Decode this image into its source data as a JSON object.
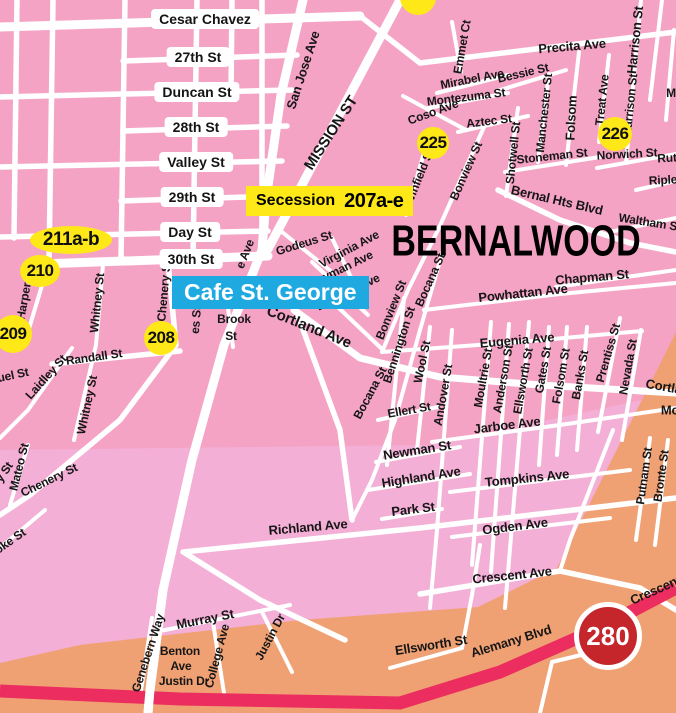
{
  "map": {
    "region_title": "BERNALWOOD",
    "colors": {
      "pink": "#F5A3C5",
      "light_pink": "#F3AFD6",
      "orange": "#F0A173",
      "road": "#FFFFFF",
      "freeway": "#EB2D5F",
      "yellow": "#FFE817",
      "blue": "#1EA9E1",
      "red": "#C4262B",
      "label_text": "#161616"
    },
    "banners": {
      "secession_name": "Secession",
      "secession_units": "207a-e",
      "cafe": "Cafe St. George"
    },
    "highway": {
      "shield": "280"
    },
    "pills": [
      {
        "t": "Cesar Chavez",
        "x": 205,
        "y": 19
      },
      {
        "t": "27th St",
        "x": 198,
        "y": 57
      },
      {
        "t": "Duncan St",
        "x": 197,
        "y": 92
      },
      {
        "t": "28th St",
        "x": 196,
        "y": 127
      },
      {
        "t": "Valley St",
        "x": 196,
        "y": 162
      },
      {
        "t": "29th St",
        "x": 192,
        "y": 197
      },
      {
        "t": "Day St",
        "x": 190,
        "y": 232
      },
      {
        "t": "30th St",
        "x": 191,
        "y": 259
      }
    ],
    "badges": [
      {
        "t": "225",
        "x": 433,
        "y": 143,
        "rx": 16,
        "ry": 16
      },
      {
        "t": "226",
        "x": 615,
        "y": 134,
        "rx": 17,
        "ry": 17
      },
      {
        "t": "208",
        "x": 161,
        "y": 338,
        "rx": 17,
        "ry": 17
      },
      {
        "t": "209",
        "x": 13,
        "y": 334,
        "rx": 19,
        "ry": 19
      },
      {
        "t": "210",
        "x": 40,
        "y": 271,
        "rx": 20,
        "ry": 16
      },
      {
        "t": "211a-b",
        "x": 71,
        "y": 240,
        "rx": 41,
        "ry": 14,
        "fs": 19
      },
      {
        "t": "",
        "x": 418,
        "y": -3,
        "rx": 18,
        "ry": 18
      }
    ],
    "labels": [
      {
        "t": "San Jose Ave",
        "x": 303,
        "y": 70,
        "r": -72
      },
      {
        "t": "MISSION ST",
        "x": 331,
        "y": 133,
        "r": -57,
        "fs": 15
      },
      {
        "t": "Emmet Ct",
        "x": 462,
        "y": 47,
        "r": -80,
        "fs": 12
      },
      {
        "t": "Precita Ave",
        "x": 572,
        "y": 46,
        "r": -5
      },
      {
        "t": "Harrison St",
        "x": 635,
        "y": 40,
        "r": -84
      },
      {
        "t": "Harrison St",
        "x": 630,
        "y": 105,
        "r": -84,
        "fs": 12
      },
      {
        "t": "Treat Ave",
        "x": 602,
        "y": 100,
        "r": -84,
        "fs": 12
      },
      {
        "t": "Folsom",
        "x": 571,
        "y": 118,
        "r": -87
      },
      {
        "t": "Manchester St",
        "x": 544,
        "y": 113,
        "r": -84,
        "fs": 12
      },
      {
        "t": "Mirabel Ave",
        "x": 472,
        "y": 79,
        "r": -11,
        "fs": 12
      },
      {
        "t": "Bessie St",
        "x": 523,
        "y": 73,
        "r": -13,
        "fs": 12
      },
      {
        "t": "Montezuma St",
        "x": 466,
        "y": 97,
        "r": -7,
        "fs": 12
      },
      {
        "t": "Coso Ave",
        "x": 433,
        "y": 112,
        "r": -20,
        "fs": 12
      },
      {
        "t": "Aztec St",
        "x": 489,
        "y": 121,
        "r": -7,
        "fs": 12
      },
      {
        "t": "Shotwell St",
        "x": 513,
        "y": 153,
        "r": -84,
        "fs": 12
      },
      {
        "t": "Stoneman St",
        "x": 552,
        "y": 156,
        "r": -6,
        "fs": 12
      },
      {
        "t": "Winfield St",
        "x": 419,
        "y": 177,
        "r": -68,
        "fs": 12
      },
      {
        "t": "Bonview St",
        "x": 466,
        "y": 171,
        "r": -66,
        "fs": 12
      },
      {
        "t": "Norwich St",
        "x": 627,
        "y": 154,
        "r": -3,
        "fs": 12
      },
      {
        "t": "Rut",
        "x": 667,
        "y": 158,
        "r": -3,
        "fs": 12
      },
      {
        "t": "Riple",
        "x": 663,
        "y": 180,
        "r": -3,
        "fs": 12
      },
      {
        "t": "M",
        "x": 671,
        "y": 93,
        "r": 0,
        "fs": 12
      },
      {
        "t": "Bernal Hts Blvd",
        "x": 557,
        "y": 200,
        "r": 13
      },
      {
        "t": "Waltham S",
        "x": 648,
        "y": 222,
        "r": 9,
        "fs": 12
      },
      {
        "t": "Chapman St",
        "x": 592,
        "y": 277,
        "r": -5
      },
      {
        "t": "Powhattan Ave",
        "x": 523,
        "y": 293,
        "r": -6
      },
      {
        "t": "Godeus St",
        "x": 304,
        "y": 243,
        "r": -17,
        "fs": 12
      },
      {
        "t": "Virginia Ave",
        "x": 349,
        "y": 249,
        "r": -28,
        "fs": 12
      },
      {
        "t": "Heyman Ave",
        "x": 341,
        "y": 269,
        "r": -26,
        "fs": 12
      },
      {
        "t": "Eugenia Ave",
        "x": 348,
        "y": 292,
        "r": -26,
        "fs": 12
      },
      {
        "t": "Bonview St",
        "x": 391,
        "y": 310,
        "r": -68,
        "fs": 12
      },
      {
        "t": "Bocana St",
        "x": 430,
        "y": 280,
        "r": -66,
        "fs": 12
      },
      {
        "t": "Bocana St",
        "x": 370,
        "y": 393,
        "r": -62,
        "fs": 12
      },
      {
        "t": "Bennington St",
        "x": 399,
        "y": 345,
        "r": -72,
        "fs": 12
      },
      {
        "t": "Wool St",
        "x": 422,
        "y": 362,
        "r": -78,
        "fs": 12
      },
      {
        "t": "Andover St",
        "x": 443,
        "y": 395,
        "r": -80,
        "fs": 12
      },
      {
        "t": "Moultrie St",
        "x": 483,
        "y": 378,
        "r": -80,
        "fs": 12
      },
      {
        "t": "Anderson St",
        "x": 503,
        "y": 379,
        "r": -80,
        "fs": 12
      },
      {
        "t": "Ellsworth St",
        "x": 523,
        "y": 381,
        "r": -80,
        "fs": 12
      },
      {
        "t": "Gates St",
        "x": 543,
        "y": 370,
        "r": -80,
        "fs": 12
      },
      {
        "t": "Folsom St",
        "x": 561,
        "y": 376,
        "r": -80,
        "fs": 12
      },
      {
        "t": "Banks St",
        "x": 580,
        "y": 375,
        "r": -80,
        "fs": 12
      },
      {
        "t": "Prentiss St",
        "x": 608,
        "y": 353,
        "r": -74,
        "fs": 12
      },
      {
        "t": "Nevada St",
        "x": 628,
        "y": 367,
        "r": -80,
        "fs": 12
      },
      {
        "t": "Eugenia Ave",
        "x": 517,
        "y": 340,
        "r": -5
      },
      {
        "t": "Cortland Ave",
        "x": 309,
        "y": 327,
        "r": 22,
        "fs": 15
      },
      {
        "t": "Cortland Ave",
        "x": 684,
        "y": 390,
        "r": 10
      },
      {
        "t": "Mo",
        "x": 670,
        "y": 410,
        "r": 0
      },
      {
        "t": "Ellert St",
        "x": 409,
        "y": 410,
        "r": -10,
        "fs": 12
      },
      {
        "t": "Jarboe Ave",
        "x": 507,
        "y": 425,
        "r": -7
      },
      {
        "t": "Newman St",
        "x": 417,
        "y": 450,
        "r": -9
      },
      {
        "t": "Highland Ave",
        "x": 421,
        "y": 477,
        "r": -9
      },
      {
        "t": "Tompkins Ave",
        "x": 527,
        "y": 478,
        "r": -6
      },
      {
        "t": "Park St",
        "x": 413,
        "y": 509,
        "r": -7
      },
      {
        "t": "Ogden Ave",
        "x": 515,
        "y": 526,
        "r": -7
      },
      {
        "t": "Crescent Ave",
        "x": 512,
        "y": 575,
        "r": -6
      },
      {
        "t": "Crescent Av",
        "x": 664,
        "y": 586,
        "r": -24
      },
      {
        "t": "Ellsworth St",
        "x": 431,
        "y": 645,
        "r": -9
      },
      {
        "t": "Alemany Blvd",
        "x": 511,
        "y": 641,
        "r": -17
      },
      {
        "t": "Richland Ave",
        "x": 308,
        "y": 527,
        "r": -5
      },
      {
        "t": "Murray St",
        "x": 205,
        "y": 619,
        "r": -11
      },
      {
        "t": "Genebern Way",
        "x": 148,
        "y": 653,
        "r": -72,
        "fs": 12
      },
      {
        "t": "Benton",
        "x": 180,
        "y": 651,
        "r": 0,
        "fs": 12
      },
      {
        "t": "Ave",
        "x": 181,
        "y": 666,
        "r": 0,
        "fs": 12
      },
      {
        "t": "Justin Dr",
        "x": 184,
        "y": 681,
        "r": 0,
        "fs": 12
      },
      {
        "t": "College Ave",
        "x": 217,
        "y": 656,
        "r": -75,
        "fs": 12
      },
      {
        "t": "Justin Dr",
        "x": 270,
        "y": 637,
        "r": -62,
        "fs": 12
      },
      {
        "t": "Mateo St",
        "x": 19,
        "y": 467,
        "r": -76,
        "fs": 12
      },
      {
        "t": "Chenery St",
        "x": 49,
        "y": 480,
        "r": -26,
        "fs": 12
      },
      {
        "t": "y St",
        "x": 4,
        "y": 472,
        "r": -55,
        "fs": 12
      },
      {
        "t": "oke St",
        "x": 10,
        "y": 541,
        "r": -35,
        "fs": 12
      },
      {
        "t": "Randall St",
        "x": 94,
        "y": 357,
        "r": -8,
        "fs": 12
      },
      {
        "t": "Laidley St",
        "x": 46,
        "y": 377,
        "r": -48,
        "fs": 12
      },
      {
        "t": "uel St",
        "x": 13,
        "y": 375,
        "r": -12,
        "fs": 12
      },
      {
        "t": "Whitney St",
        "x": 97,
        "y": 303,
        "r": -84,
        "fs": 12
      },
      {
        "t": "Whitney St",
        "x": 87,
        "y": 405,
        "r": -78,
        "fs": 12
      },
      {
        "t": "Harper St",
        "x": 25,
        "y": 294,
        "r": -80,
        "fs": 12
      },
      {
        "t": "Chenery St",
        "x": 164,
        "y": 291,
        "r": -85,
        "fs": 12
      },
      {
        "t": "es St",
        "x": 196,
        "y": 320,
        "r": -85,
        "fs": 12
      },
      {
        "t": "Brook",
        "x": 234,
        "y": 319,
        "r": 0,
        "fs": 12
      },
      {
        "t": "St",
        "x": 231,
        "y": 336,
        "r": 0,
        "fs": 12
      },
      {
        "t": "e Ave",
        "x": 245,
        "y": 254,
        "r": -68,
        "fs": 12
      },
      {
        "t": "Bronte St",
        "x": 661,
        "y": 476,
        "r": -82,
        "fs": 12
      },
      {
        "t": "Putnam St",
        "x": 644,
        "y": 476,
        "r": -82,
        "fs": 12
      }
    ]
  }
}
